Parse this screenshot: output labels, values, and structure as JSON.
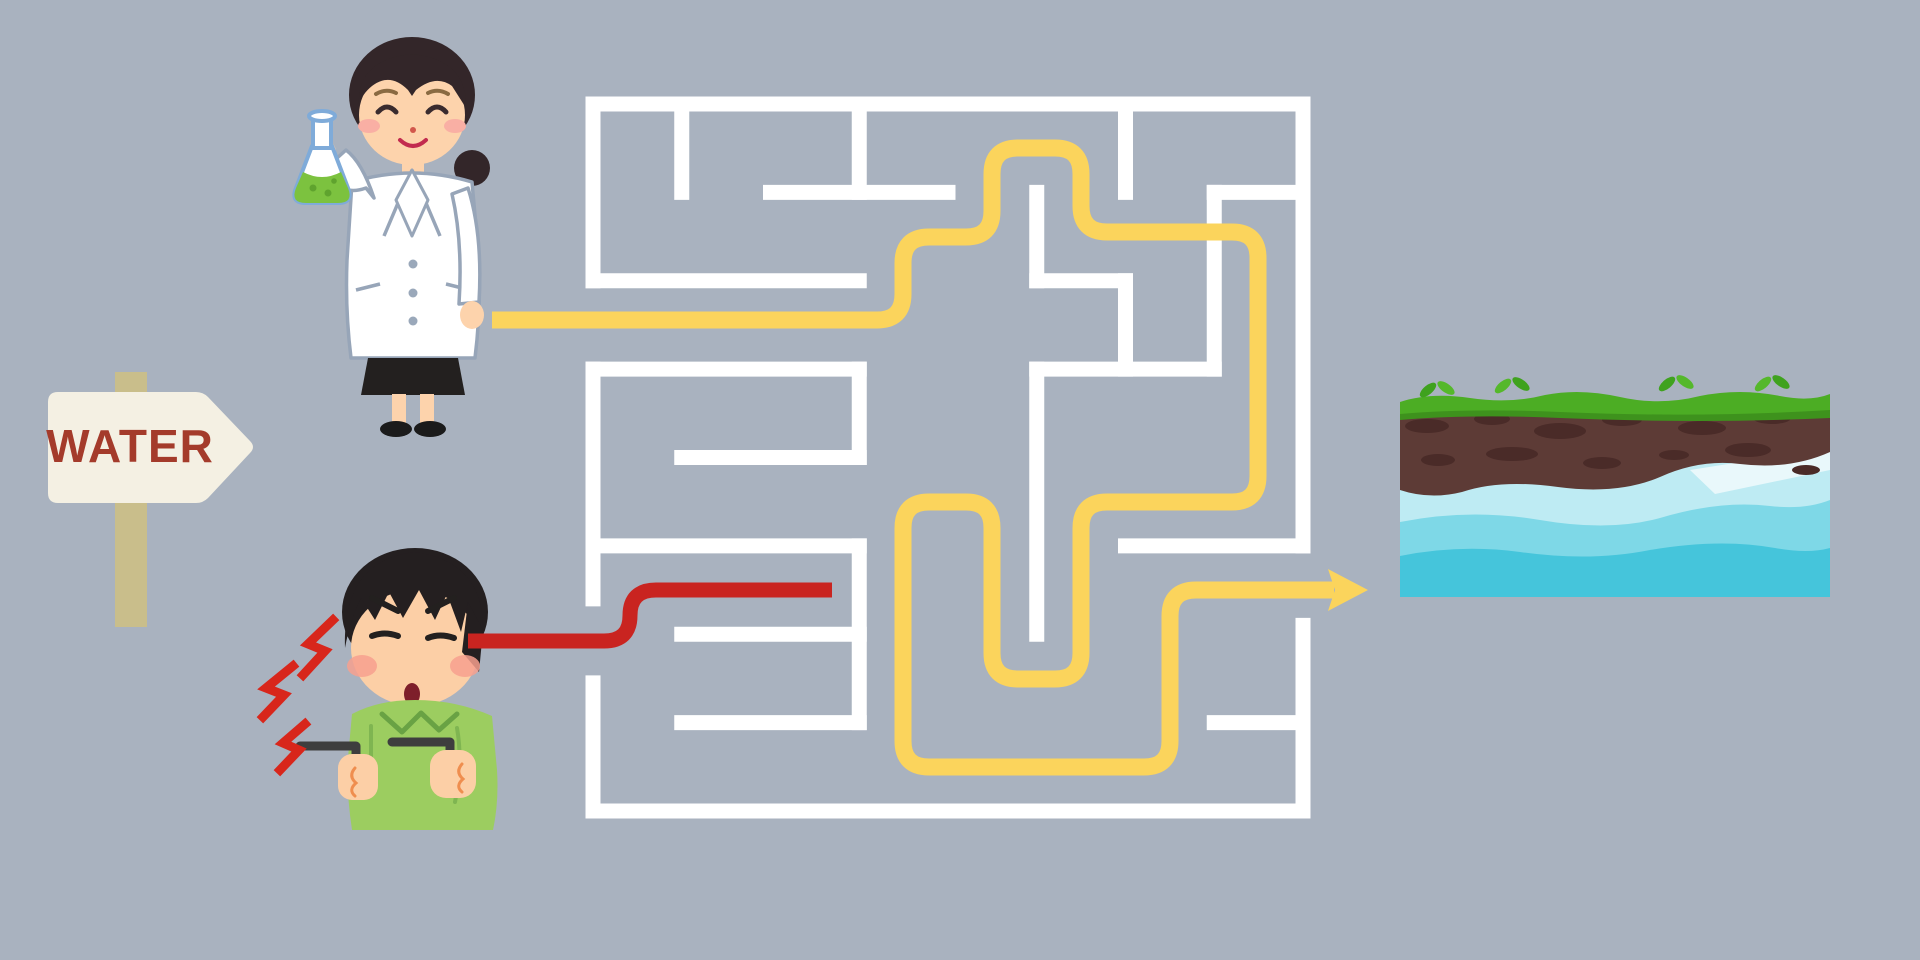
{
  "sign": {
    "label": "WATER"
  },
  "palette": {
    "background": "#A9B2BF",
    "wall": "#FFFFFF",
    "yellow_path": "#FBD45C",
    "red_path": "#C92420",
    "sign_board": "#F4F0E3",
    "sign_text": "#A43B2B",
    "sign_post": "#C9BE8B",
    "grass": "#4CAD24",
    "grass_rim": "#3E921D",
    "soil": "#5D3B36",
    "soil_blob": "#4A2B28",
    "water_light": "#BEEBF3",
    "water_mid": "#7ED8E7",
    "water_deep": "#45C5DB",
    "rod": "#3E3E3E",
    "bolt": "#D8261B",
    "sweater": "#9CCD60",
    "coat_outline": "#97A5B8"
  },
  "maze": {
    "grid_x": [
      593,
      682,
      770,
      859,
      948,
      1037,
      1125,
      1214,
      1303
    ],
    "grid_y": [
      104,
      192,
      281,
      369,
      458,
      546,
      634,
      723,
      811
    ],
    "wall_thickness": 15,
    "walls_h": [
      [
        0,
        0,
        8
      ],
      [
        1,
        2,
        4
      ],
      [
        1,
        7,
        8
      ],
      [
        2,
        0,
        3
      ],
      [
        2,
        5,
        6
      ],
      [
        3,
        0,
        3
      ],
      [
        3,
        5,
        7
      ],
      [
        4,
        1,
        3
      ],
      [
        5,
        0,
        3
      ],
      [
        5,
        6,
        8
      ],
      [
        6,
        1,
        3
      ],
      [
        7,
        1,
        3
      ],
      [
        7,
        7,
        8
      ],
      [
        8,
        0,
        8
      ]
    ],
    "walls_v": [
      [
        0,
        0,
        2
      ],
      [
        0,
        3,
        5.6
      ],
      [
        0,
        6.55,
        8
      ],
      [
        1,
        0,
        1
      ],
      [
        3,
        0,
        1
      ],
      [
        3,
        3,
        4
      ],
      [
        3,
        5,
        7
      ],
      [
        5,
        1,
        2
      ],
      [
        5,
        3,
        6
      ],
      [
        6,
        0,
        1
      ],
      [
        6,
        2,
        3
      ],
      [
        7,
        1,
        3
      ],
      [
        8,
        0,
        5
      ],
      [
        8,
        5.9,
        8
      ]
    ],
    "yellow_path": {
      "stroke_width": 17,
      "corner_radius": 26,
      "waypoints": [
        [
          492,
          320
        ],
        [
          903,
          320
        ],
        [
          903,
          237
        ],
        [
          992,
          237
        ],
        [
          992,
          148
        ],
        [
          1081,
          148
        ],
        [
          1081,
          232
        ],
        [
          1258,
          232
        ],
        [
          1258,
          502
        ],
        [
          1081,
          502
        ],
        [
          1081,
          679
        ],
        [
          992,
          679
        ],
        [
          992,
          502
        ],
        [
          903,
          502
        ],
        [
          903,
          767
        ],
        [
          1170,
          767
        ],
        [
          1170,
          590
        ],
        [
          1334,
          590
        ]
      ],
      "arrow_head": [
        [
          1368,
          590
        ],
        [
          1328,
          569
        ],
        [
          1335,
          590
        ],
        [
          1328,
          611
        ]
      ]
    },
    "red_path": {
      "stroke_width": 15,
      "corner_radius": 26,
      "waypoints": [
        [
          468,
          641
        ],
        [
          630,
          641
        ],
        [
          630,
          590
        ],
        [
          832,
          590
        ]
      ]
    }
  }
}
